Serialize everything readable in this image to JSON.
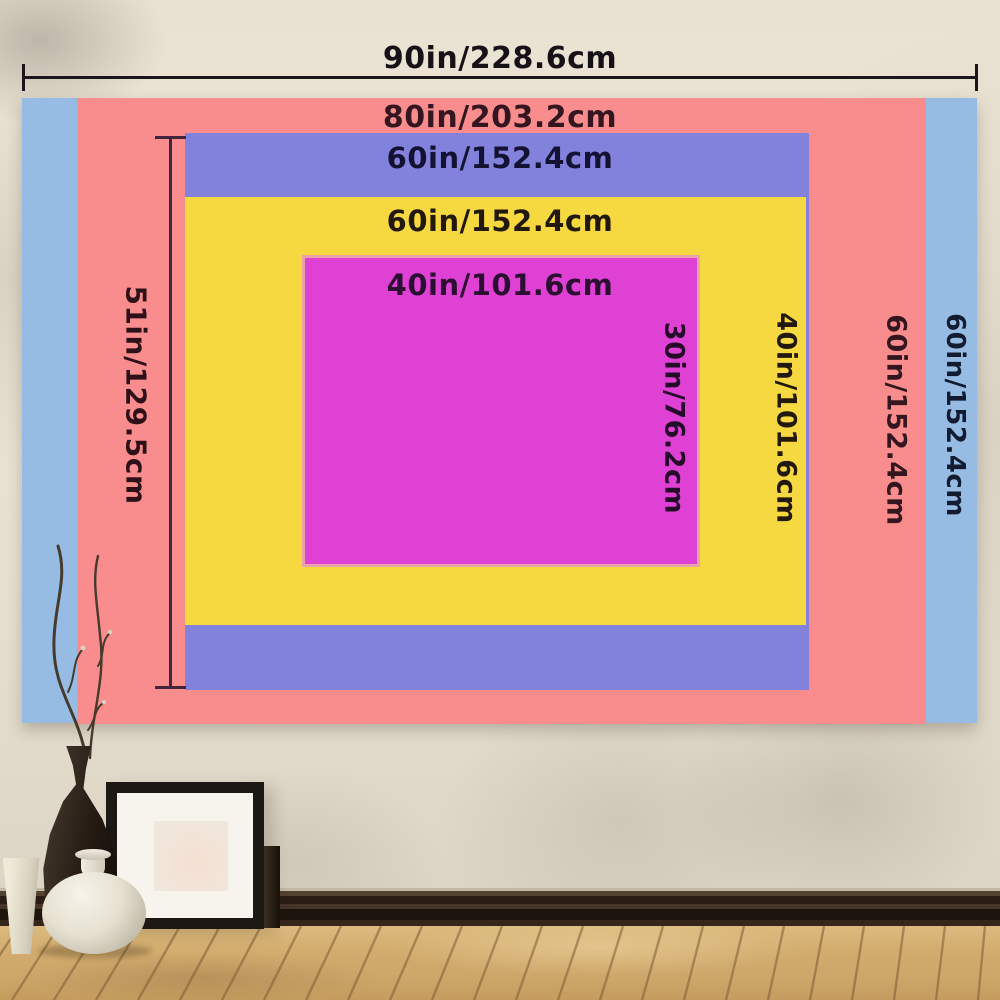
{
  "layers": [
    {
      "name": "blue",
      "color": "#96bce4",
      "width_label": "90in/228.6cm",
      "height_label": "60in/152.4cm"
    },
    {
      "name": "pink",
      "color": "#f98d8d",
      "width_label": "80in/203.2cm",
      "height_label": "60in/152.4cm"
    },
    {
      "name": "purple",
      "color": "#8282dc",
      "width_label": "60in/152.4cm",
      "height_label": "51in/129.5cm"
    },
    {
      "name": "yellow",
      "color": "#f6d840",
      "width_label": "60in/152.4cm",
      "height_label": "40in/101.6cm"
    },
    {
      "name": "magenta",
      "color": "#de41d4",
      "width_label": "40in/101.6cm",
      "height_label": "30in/76.2cm"
    }
  ],
  "palette": {
    "wall": "#e8e1d1",
    "floor_wood": "#cfa96a",
    "baseboard": "#2a1d15",
    "top_measure_line": "#1b161a",
    "side_measure_line": "#41243e",
    "label_text": "#1b1218",
    "magenta_border": "#e9a4a9"
  }
}
